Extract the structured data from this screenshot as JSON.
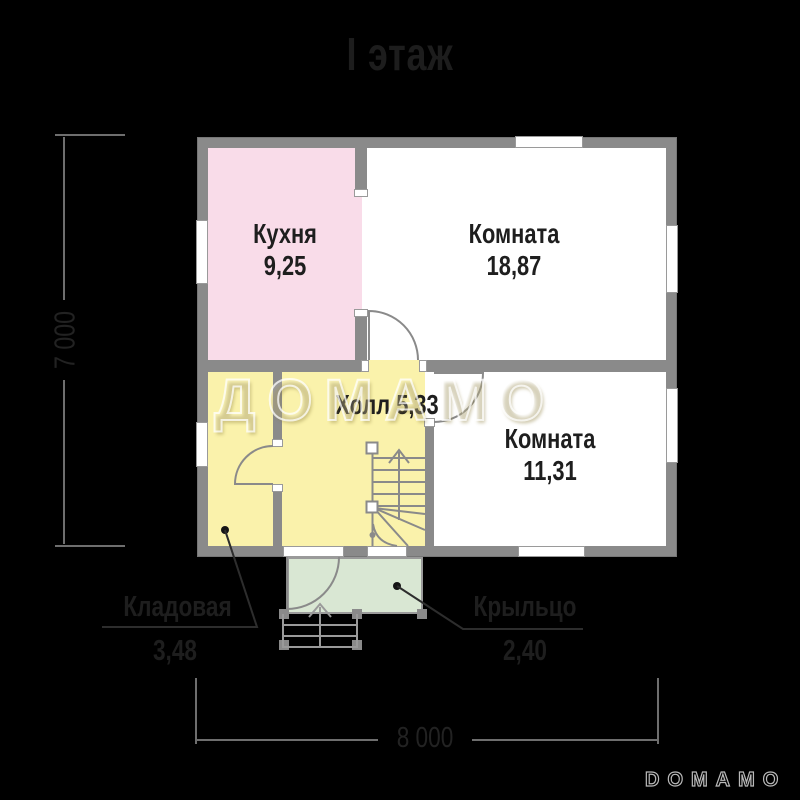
{
  "title": "I этаж",
  "watermark": "ДОМАМО",
  "brand": "DOMAMO",
  "rooms": {
    "kitchen": {
      "name": "Кухня",
      "area": "9,25"
    },
    "room_large": {
      "name": "Комната",
      "area": "18,87"
    },
    "hall": {
      "name": "Холл",
      "area": "5,33"
    },
    "room_small": {
      "name": "Комната",
      "area": "11,31"
    },
    "storage": {
      "name": "Кладовая",
      "area": "3,48"
    },
    "porch": {
      "name": "Крыльцо",
      "area": "2,40"
    }
  },
  "dimensions": {
    "width": "8 000",
    "height": "7 000"
  },
  "colors": {
    "background": "#000000",
    "wall": "#8A8A8A",
    "kitchen_fill": "#F9DCE9",
    "hall_fill": "#FAF2AB",
    "room_fill": "#FFFFFF",
    "porch_fill": "#D9E7D3",
    "label_text": "#1E1E1E",
    "dimension_line": "#6E6E6E"
  }
}
